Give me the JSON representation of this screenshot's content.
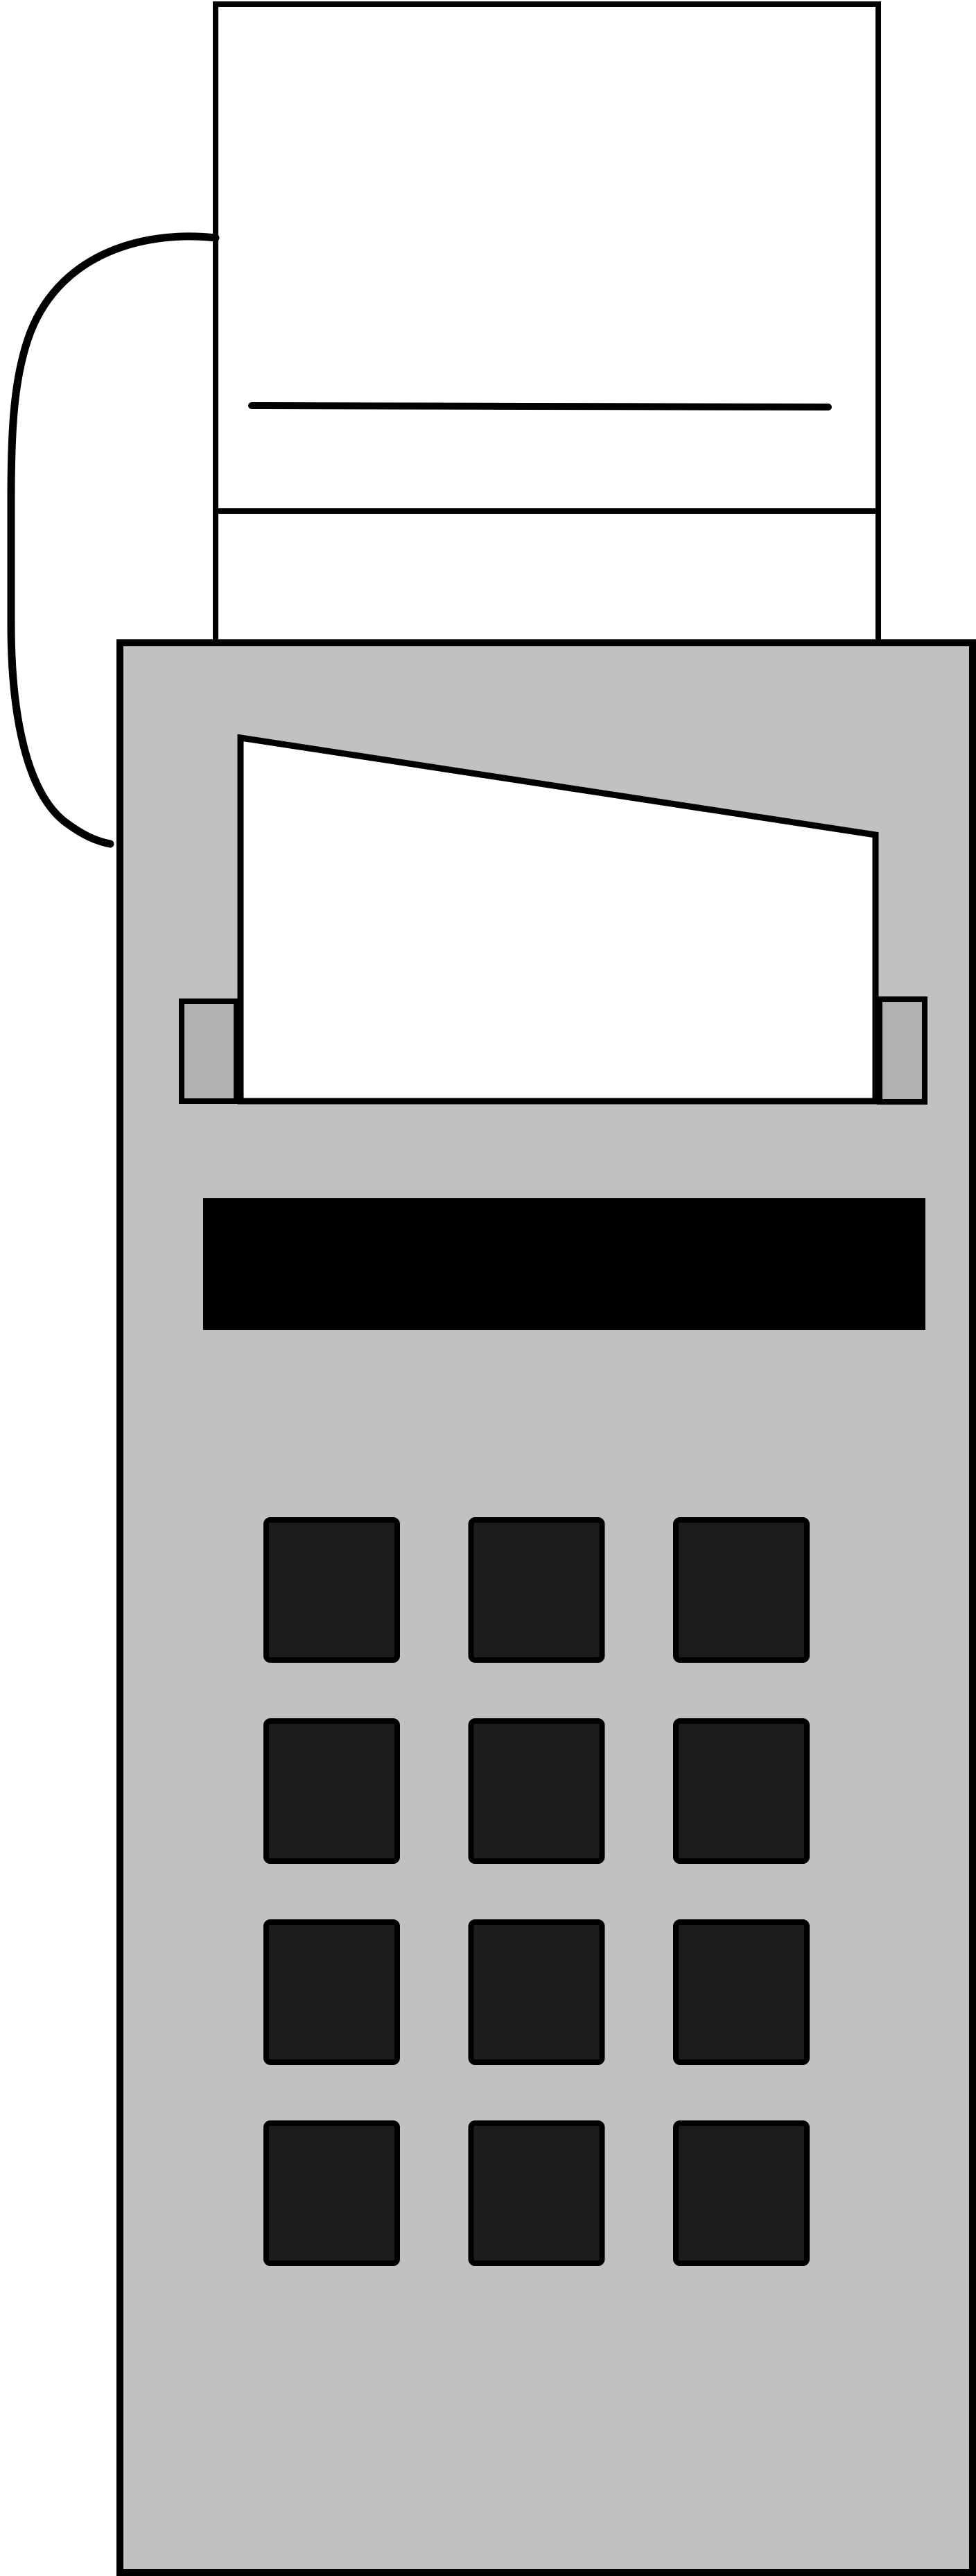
{
  "device": {
    "kind": "card-terminal-with-receipt-printer-illustration",
    "display": {
      "text": ""
    },
    "keypad": {
      "rows": 4,
      "columns": 3,
      "button_count": 12
    },
    "colors": {
      "background": "#ffffff",
      "outline": "#000000",
      "body": "#c1c1c1",
      "slot_bracket": "#b1b1b1",
      "paper": "#ffffff",
      "display": "#000000",
      "button": "#1c1c1e"
    }
  }
}
